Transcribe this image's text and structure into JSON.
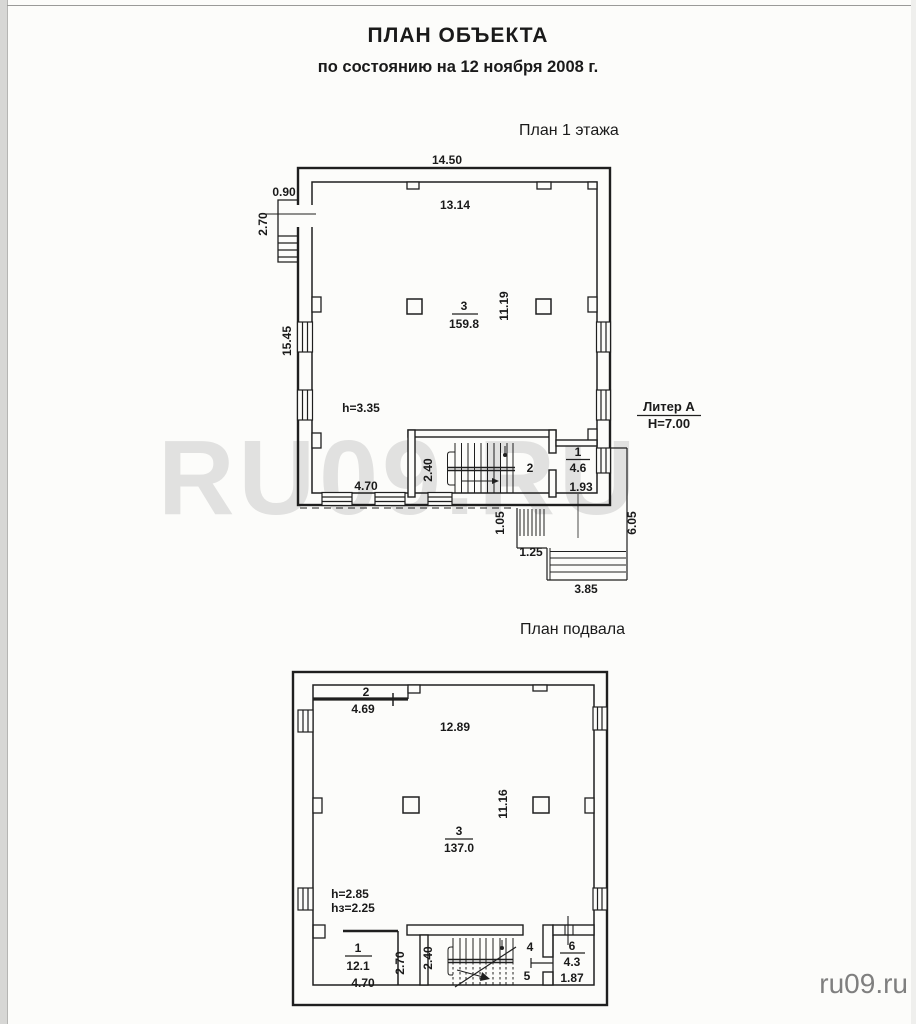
{
  "page": {
    "title": "ПЛАН ОБЪЕКТА",
    "subtitle": "по состоянию на 12 ноября 2008 г.",
    "watermark": "RU09.RU",
    "credit": "ru09.ru"
  },
  "floor1": {
    "title": "План 1 этажа",
    "dim_top_width": "14.50",
    "dim_inner_width": "13.14",
    "dim_porch_width": "0.90",
    "dim_porch_depth": "2.70",
    "dim_left_height": "15.45",
    "dim_inner_height": "11.19",
    "room3_number": "3",
    "room3_area": "159.8",
    "ceiling_height": "h=3.35",
    "dim_stair_width": "2.40",
    "room2_number": "2",
    "room1_number": "1",
    "room1_area": "4.6",
    "dim_room1_width": "1.93",
    "dim_bottom_left": "4.70",
    "liter_name": "Литер А",
    "liter_height": "H=7.00",
    "dim_ext_stair": "1.05",
    "dim_ext_landing": "1.25",
    "dim_ext_steps": "3.85",
    "dim_ext_side": "6.05"
  },
  "basement": {
    "title": "План подвала",
    "room2_number": "2",
    "dim_room2_width": "4.69",
    "dim_inner_width": "12.89",
    "dim_inner_height": "11.16",
    "room3_number": "3",
    "room3_area": "137.0",
    "ceiling_height": "h=2.85",
    "floor_height": "hз=2.25",
    "room1_number": "1",
    "room1_area": "12.1",
    "dim_room1_width": "4.70",
    "dim_corridor": "2.70",
    "dim_stair_width": "2.40",
    "room4_number": "4",
    "room5_number": "5",
    "room6_number": "6",
    "room6_area": "4.3",
    "dim_room6_width": "1.87"
  }
}
